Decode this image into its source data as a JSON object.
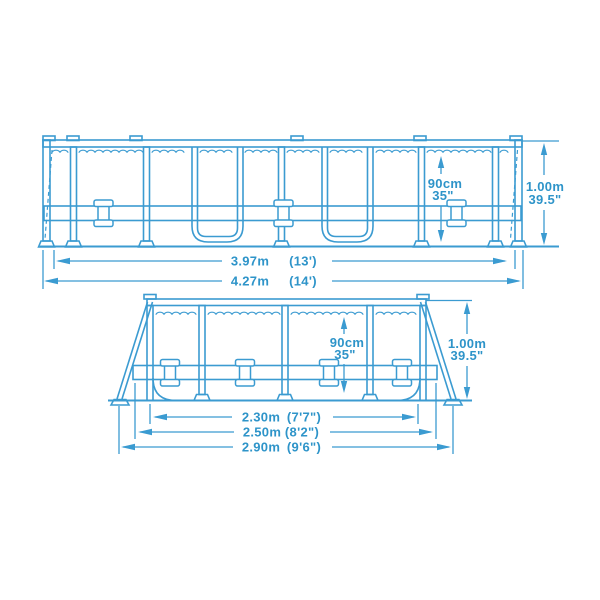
{
  "colors": {
    "line": "#3b9bd1",
    "text": "#2e94c9",
    "background": "#ffffff"
  },
  "side_view": {
    "water_depth": {
      "metric": "90cm",
      "imperial": "35\""
    },
    "frame_height": {
      "metric": "1.00m",
      "imperial": "39.5\""
    },
    "dim_inner": {
      "metric": "3.97m",
      "imperial": "(13')"
    },
    "dim_outer": {
      "metric": "4.27m",
      "imperial": "(14')"
    }
  },
  "end_view": {
    "water_depth": {
      "metric": "90cm",
      "imperial": "35\""
    },
    "frame_height": {
      "metric": "1.00m",
      "imperial": "39.5\""
    },
    "dim_top": {
      "metric": "2.30m",
      "imperial": "(7'7\")"
    },
    "dim_mid": {
      "metric": "2.50m",
      "imperial": "(8'2\")"
    },
    "dim_base": {
      "metric": "2.90m",
      "imperial": "(9'6\")"
    }
  }
}
